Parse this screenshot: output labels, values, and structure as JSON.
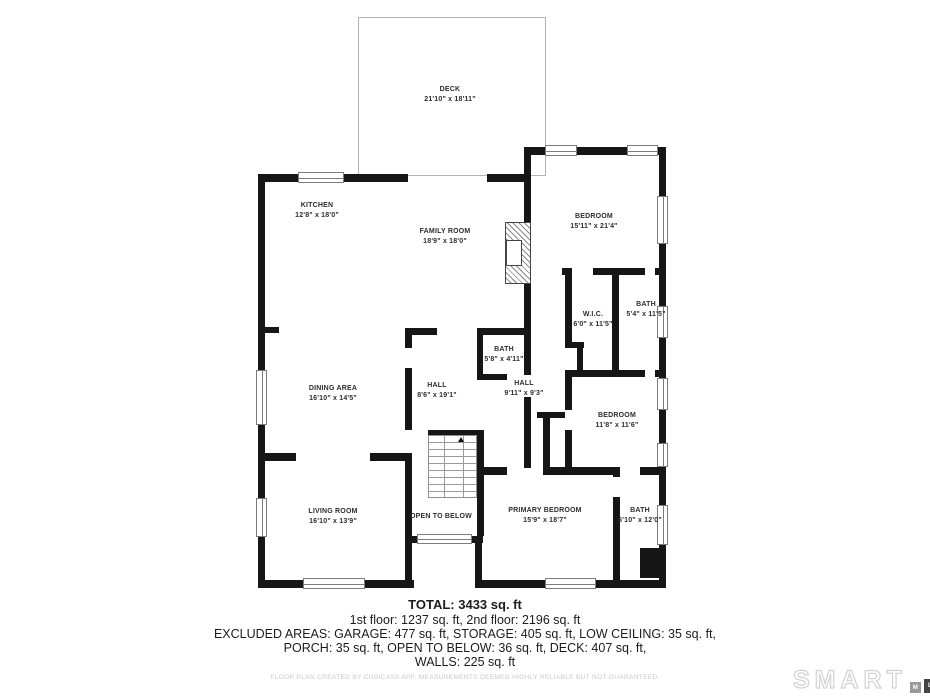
{
  "rooms": [
    {
      "name": "DECK",
      "dims": "21'10\" x 18'11\""
    },
    {
      "name": "KITCHEN",
      "dims": "12'8\" x 18'0\""
    },
    {
      "name": "FAMILY ROOM",
      "dims": "18'9\" x 18'0\""
    },
    {
      "name": "BEDROOM",
      "dims": "15'11\" x 21'4\""
    },
    {
      "name": "W.I.C.",
      "dims": "6'0\" x 11'5\""
    },
    {
      "name": "BATH",
      "dims": "5'4\" x 11'5\""
    },
    {
      "name": "BATH",
      "dims": "5'8\" x 4'11\""
    },
    {
      "name": "HALL",
      "dims": "8'6\" x 19'1\""
    },
    {
      "name": "HALL",
      "dims": "9'11\" x 9'3\""
    },
    {
      "name": "DINING AREA",
      "dims": "16'10\" x 14'5\""
    },
    {
      "name": "BEDROOM",
      "dims": "11'8\" x 11'6\""
    },
    {
      "name": "LIVING ROOM",
      "dims": "16'10\" x 13'9\""
    },
    {
      "name": "OPEN TO BELOW",
      "dims": ""
    },
    {
      "name": "PRIMARY BEDROOM",
      "dims": "15'9\" x 18'7\""
    },
    {
      "name": "BATH",
      "dims": "5'10\" x 12'0\""
    }
  ],
  "summary": {
    "total": "TOTAL: 3433 sq. ft",
    "line1": "1st floor: 1237 sq. ft, 2nd floor: 2196 sq. ft",
    "line2": "EXCLUDED AREAS: GARAGE: 477 sq. ft, STORAGE: 405 sq. ft, LOW CEILING: 35 sq. ft,",
    "line3": "PORCH: 35 sq. ft, OPEN TO BELOW: 36 sq. ft, DECK: 407 sq. ft,",
    "line4": "WALLS: 225 sq. ft"
  },
  "disclaimer": "FLOOR PLAN CREATED BY CUBICASA APP. MEASUREMENTS DEEMED HIGHLY RELIABLE BUT NOT GUARANTEED.",
  "logo": {
    "brand": "SMART",
    "block_m": "M",
    "block_l": "L",
    "block_s": "S"
  },
  "colors": {
    "wall": "#161616",
    "deck_outline": "#b3b3b3",
    "disclaimer_text": "#c9c9c9",
    "logo_outline": "#d2d2d2"
  }
}
